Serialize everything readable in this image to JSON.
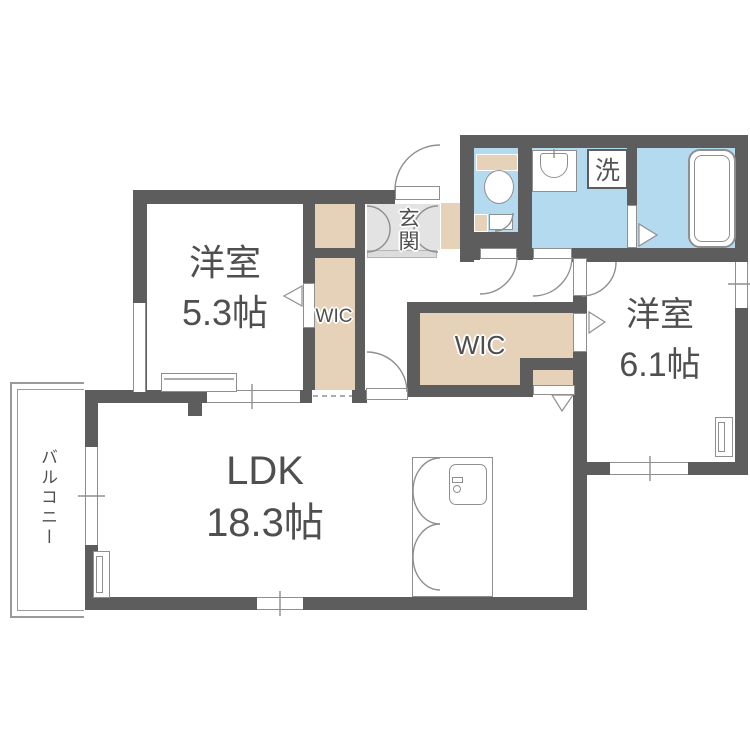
{
  "rooms": {
    "bedroom1": {
      "name": "洋室",
      "size": "5.3帖"
    },
    "bedroom2": {
      "name": "洋室",
      "size": "6.1帖"
    },
    "ldk": {
      "name": "LDK",
      "size": "18.3帖"
    },
    "wic1": {
      "label": "WIC"
    },
    "wic2": {
      "label": "WIC"
    },
    "genkan": {
      "label": "玄関"
    },
    "balcony": {
      "label": "バルコニー"
    },
    "laundry": {
      "label": "洗"
    }
  },
  "colors": {
    "wall": "#5d5d5d",
    "closet_floor": "#e5d2b8",
    "wet_floor": "#b4daf0",
    "tile_floor": "#e3e3e3",
    "symbol_line": "#8f8f8f",
    "label_text": "#4f4f4f"
  }
}
